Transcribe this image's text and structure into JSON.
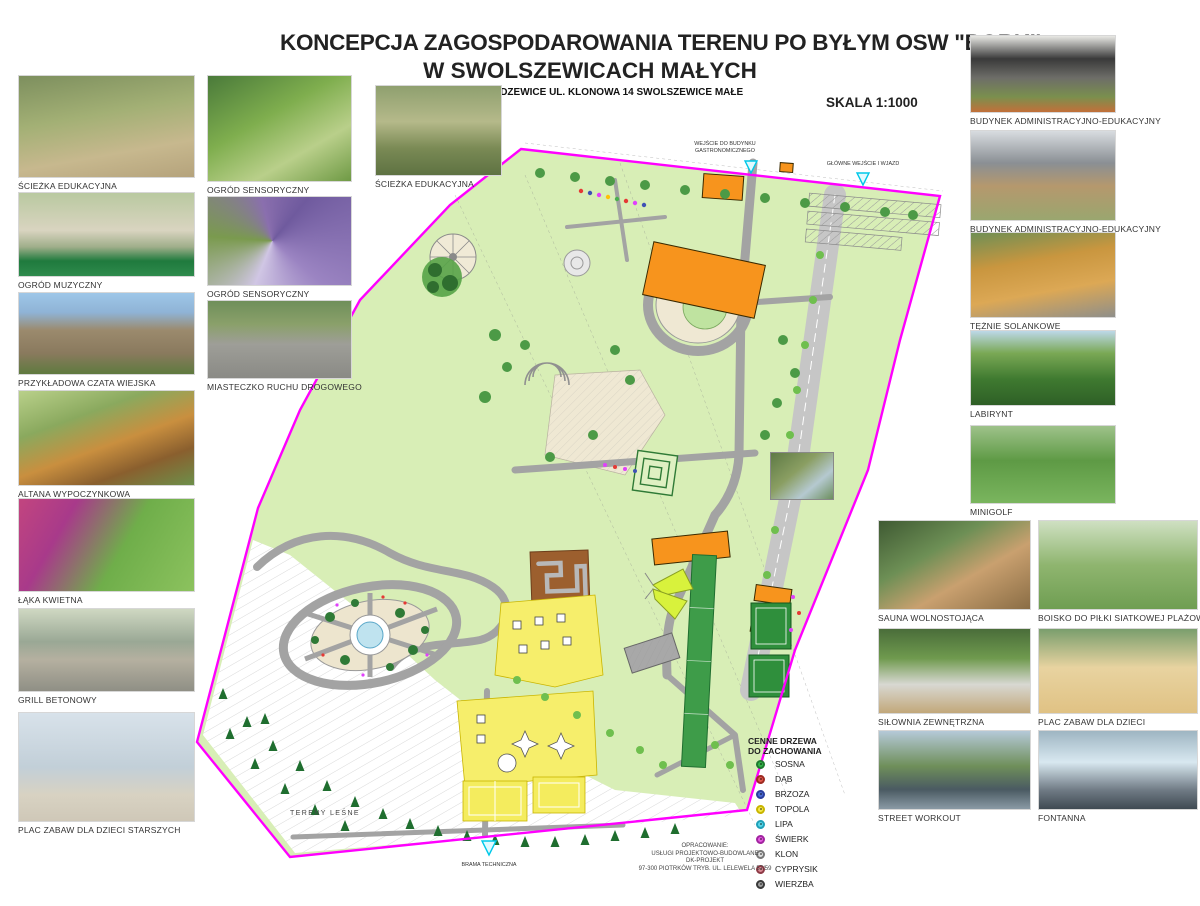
{
  "header": {
    "title_line1": "KONCEPCJA ZAGOSPODAROWANIA TERENU PO BYŁYM OSW \"BORKI'",
    "title_line2": "W SWOLSZEWICACH MAŁYCH",
    "address": "97-213  SMARDZEWICE  UL. KLONOWA 14   SWOLSZEWICE MAŁE",
    "scale": "SKALA 1:1000"
  },
  "photos": {
    "left_a": [
      {
        "caption": "ŚCIEŻKA EDUKACYJNA"
      },
      {
        "caption": "OGRÓD MUZYCZNY"
      },
      {
        "caption": "PRZYKŁADOWA CZATA WIEJSKA"
      },
      {
        "caption": "ALTANA WYPOCZYNKOWA"
      },
      {
        "caption": "ŁĄKA KWIETNA"
      },
      {
        "caption": "GRILL BETONOWY"
      },
      {
        "caption": "PLAC ZABAW DLA DZIECI STARSZYCH"
      }
    ],
    "left_b": [
      {
        "caption": "OGRÓD SENSORYCZNY"
      },
      {
        "caption": "OGRÓD SENSORYCZNY"
      },
      {
        "caption": "MIASTECZKO RUCHU DROGOWEGO"
      }
    ],
    "top": {
      "caption": "ŚCIEŻKA EDUKACYJNA"
    },
    "right": [
      {
        "caption": "BUDYNEK ADMINISTRACYJNO-EDUKACYJNY"
      },
      {
        "caption": "BUDYNEK ADMINISTRACYJNO-EDUKACYJNY"
      },
      {
        "caption": "TĘŻNIE SOLANKOWE"
      },
      {
        "caption": "LABIRYNT"
      },
      {
        "caption": "MINIGOLF"
      }
    ],
    "grid": [
      {
        "caption": "SAUNA WOLNOSTOJĄCA"
      },
      {
        "caption": "BOISKO DO PIŁKI SIATKOWEJ PLAŻOWEJ"
      },
      {
        "caption": "SIŁOWNIA ZEWNĘTRZNA"
      },
      {
        "caption": "PLAC ZABAW DLA DZIECI"
      },
      {
        "caption": "STREET WORKOUT"
      },
      {
        "caption": "FONTANNA"
      }
    ]
  },
  "legend": {
    "title_line1": "CENNE DRZEWA",
    "title_line2": "DO ZACHOWANIA",
    "items": [
      {
        "label": "SOSNA",
        "color": "#33B54A",
        "ring": "#1E7A2E"
      },
      {
        "label": "DĄB",
        "color": "#E2574C",
        "ring": "#9E2B22"
      },
      {
        "label": "BRZOZA",
        "color": "#4B6BD5",
        "ring": "#2B3F9E"
      },
      {
        "label": "TOPOLA",
        "color": "#F4E84C",
        "ring": "#C9B500"
      },
      {
        "label": "LIPA",
        "color": "#59D7E8",
        "ring": "#1FA0B8"
      },
      {
        "label": "ŚWIERK",
        "color": "#E35BE0",
        "ring": "#A224A0"
      },
      {
        "label": "KLON",
        "color": "#E0E0E0",
        "ring": "#777777"
      },
      {
        "label": "CYPRYSIK",
        "color": "#D98A94",
        "ring": "#8E3A46"
      },
      {
        "label": "WIERZBA",
        "color": "#9E9E9E",
        "ring": "#3A3A3A"
      }
    ]
  },
  "plan": {
    "labels": {
      "entrance_gastro_line1": "WEJŚCIE DO BUDYNKU",
      "entrance_gastro_line2": "GASTRONOMICZNEGO",
      "main_entrance": "GŁÓWNE WEJŚCIE I WJAZD",
      "forest": "TERENY LEŚNE",
      "tech_gate": "BRAMA TECHNICZNA"
    },
    "colors": {
      "boundary": "#FF00FF",
      "site_green": "#D8EEB6",
      "road_gray": "#A3A3A3",
      "building_orange": "#F7941D",
      "court_green": "#2F8F3C",
      "zone_yellow": "#F6EE6B",
      "water_blue": "#BFE3EF",
      "marker_cyan": "#00C8E8"
    }
  },
  "credits": {
    "line1": "OPRACOWANIE:",
    "line2": "USŁUGI PROJEKTOWO-BUDOWLANE",
    "line3": "DK-PROJEKT",
    "line4": "97-300 PIOTRKÓW TRYB. UL. LELEWELA 57/59"
  }
}
